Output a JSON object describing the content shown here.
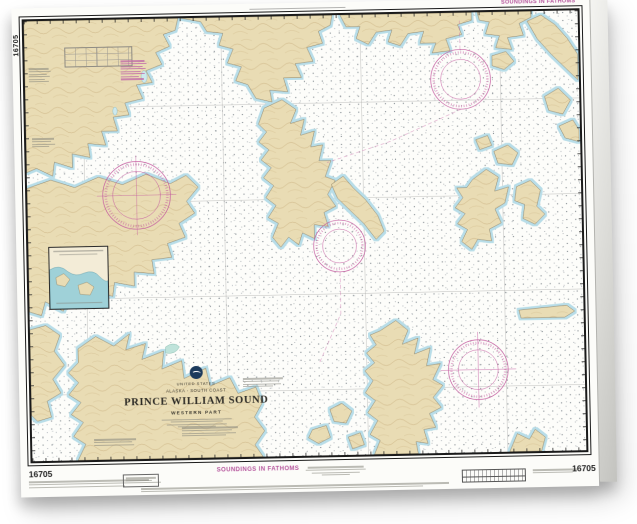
{
  "chart": {
    "number": "16705",
    "soundings_note": "SOUNDINGS IN FATHOMS",
    "title_block": {
      "country": "UNITED STATES",
      "region": "ALASKA - SOUTH COAST",
      "title": "PRINCE WILLIAM SOUND",
      "subtitle": "WESTERN PART"
    },
    "icons": {
      "noaa_emblem": "noaa-logo-icon",
      "compass_rose": "compass-rose-icon"
    },
    "colors": {
      "land": "#e9dcb4",
      "water": "#fdfdfa",
      "shallow_fringe": "#b8dde8",
      "magenta": "#b5549c",
      "neatline": "#1a1a1a",
      "contour_brown": "#c3a875"
    }
  }
}
